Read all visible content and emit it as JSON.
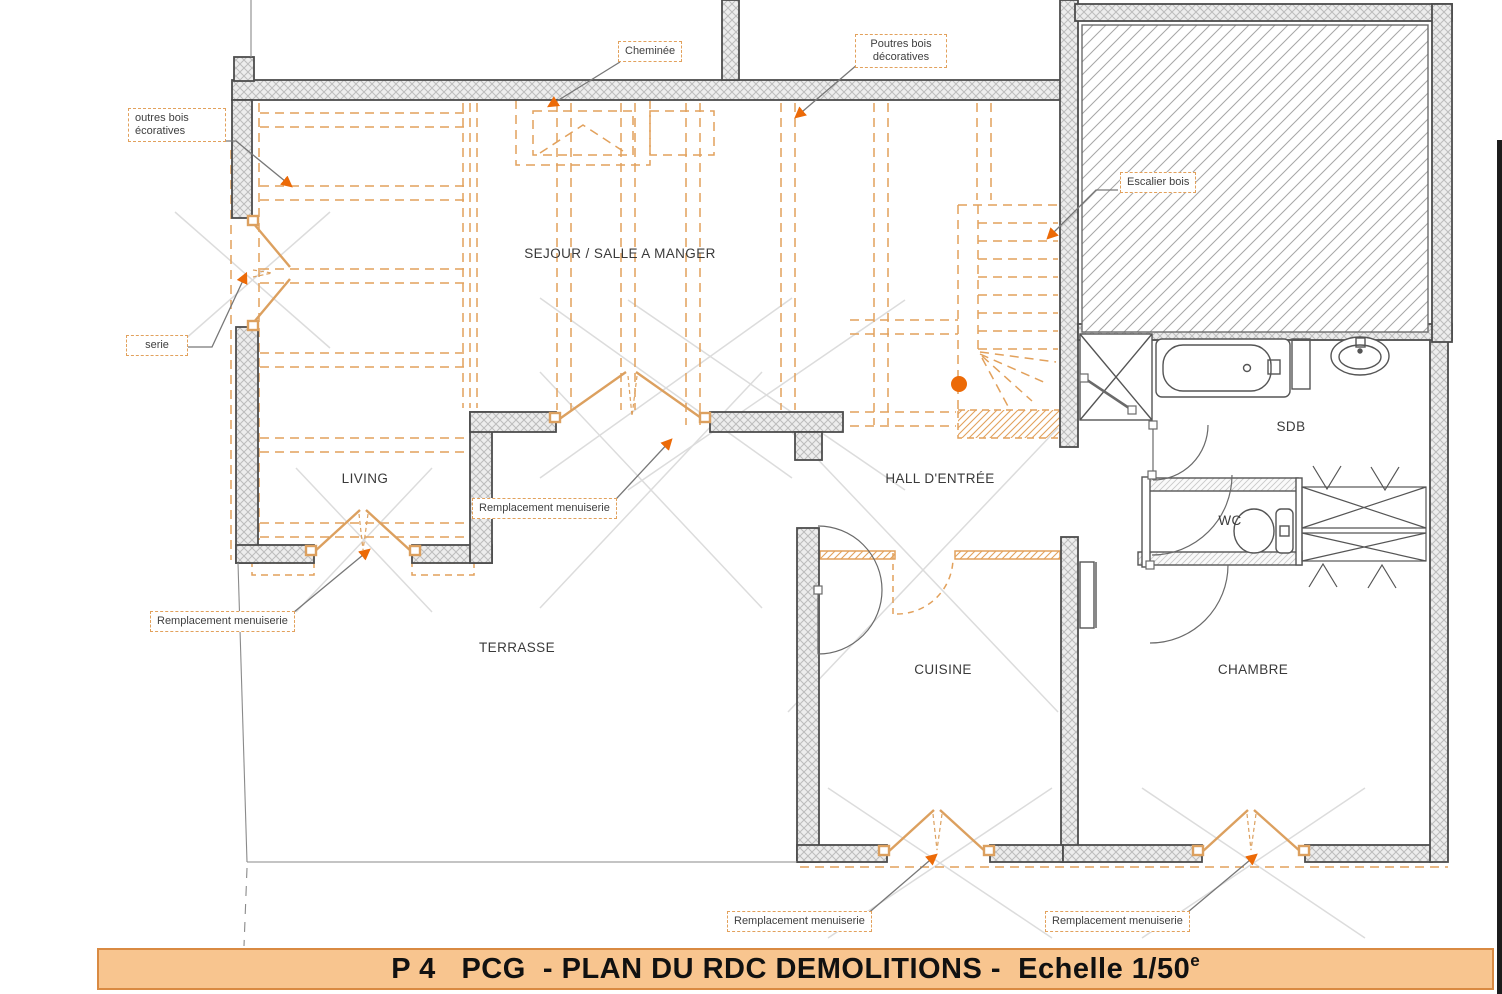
{
  "title_bar": {
    "main": "P 4   PCG  - PLAN DU RDC DEMOLITIONS -  Echelle 1/50",
    "sup": "e"
  },
  "rooms": [
    {
      "id": "sejour",
      "label": "SEJOUR / SALLE A MANGER"
    },
    {
      "id": "living",
      "label": "LIVING"
    },
    {
      "id": "terrasse",
      "label": "TERRASSE"
    },
    {
      "id": "hall",
      "label": "HALL D'ENTRÉE"
    },
    {
      "id": "cuisine",
      "label": "CUISINE"
    },
    {
      "id": "chambre",
      "label": "CHAMBRE"
    },
    {
      "id": "sdb",
      "label": "SDB"
    },
    {
      "id": "wc",
      "label": "WC"
    }
  ],
  "annotations": [
    {
      "id": "cheminee",
      "label": "Cheminée"
    },
    {
      "id": "poutres-right",
      "label": "Poutres bois décoratives"
    },
    {
      "id": "poutres-left",
      "label": "outres bois écoratives"
    },
    {
      "id": "menuiserie-cut",
      "label": "serie"
    },
    {
      "id": "rempl-center",
      "label": "Remplacement menuiserie"
    },
    {
      "id": "rempl-left",
      "label": "Remplacement menuiserie"
    },
    {
      "id": "rempl-bottom-1",
      "label": "Remplacement menuiserie"
    },
    {
      "id": "rempl-bottom-2",
      "label": "Remplacement menuiserie"
    },
    {
      "id": "escalier-bois",
      "label": "Escalier bois"
    }
  ],
  "colors": {
    "demolition_orange": "#E2A15C",
    "arrow_orange": "#EC6A07",
    "wall_edge_gray": "#4d4d4d",
    "title_background": "#F8C58F",
    "title_border": "#D98A42"
  }
}
